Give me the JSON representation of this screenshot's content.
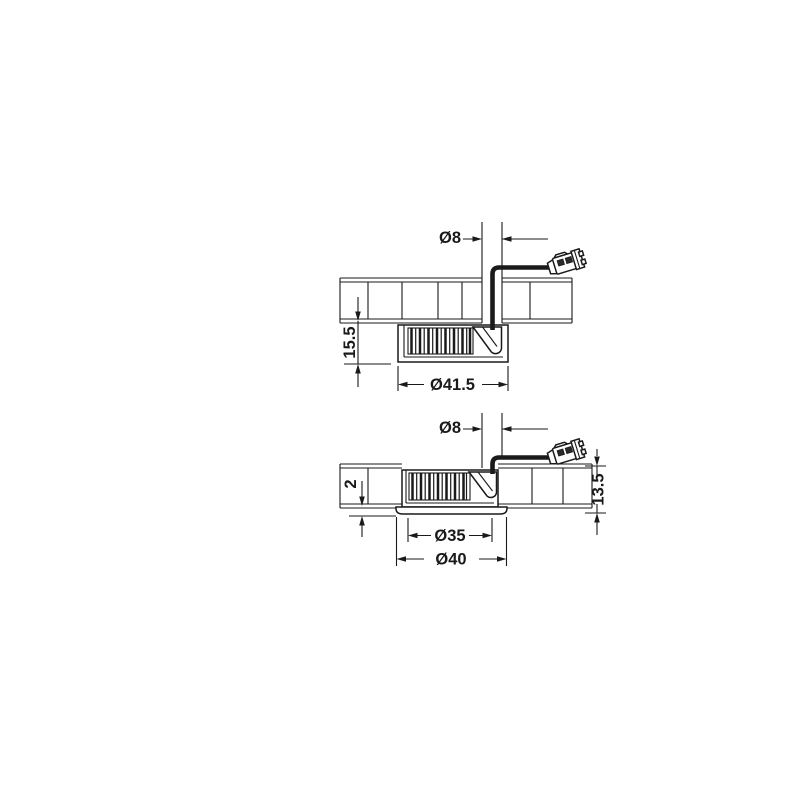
{
  "drawing": {
    "background": "#ffffff",
    "ink_color": "#1a1a1a",
    "view_top": {
      "description": "surface-mounted-downlight-cross-section",
      "dims": {
        "hole": "Ø8",
        "height": "15.5",
        "diameter": "Ø41.5"
      }
    },
    "view_bottom": {
      "description": "flush-mounted-downlight-cross-section",
      "dims": {
        "hole": "Ø8",
        "protrusion": "2",
        "depth": "13.5",
        "cutout": "Ø35",
        "flange": "Ø40"
      }
    }
  }
}
